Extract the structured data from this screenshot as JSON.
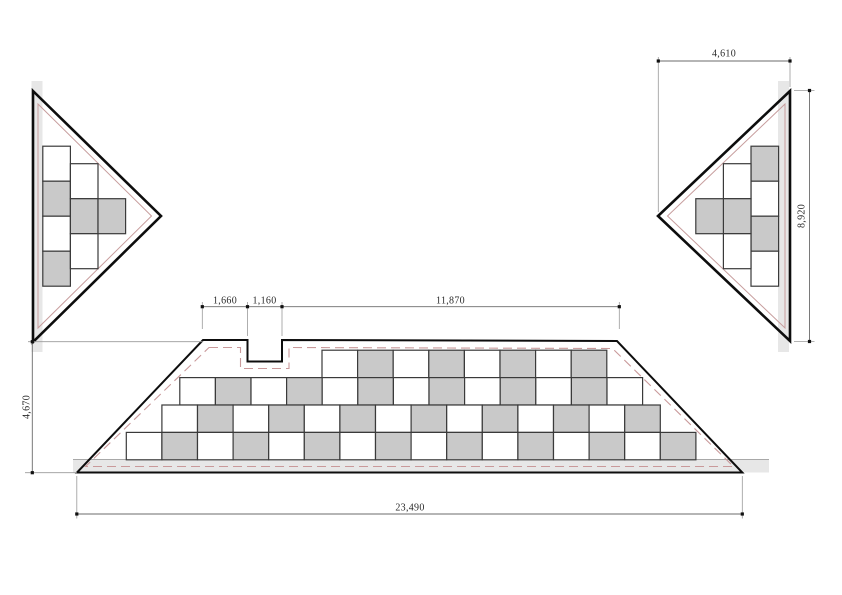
{
  "drawing": {
    "canvas": {
      "width": 842,
      "height": 595,
      "background": "#ffffff"
    },
    "palette": {
      "cell_gray": "#c9c9c9",
      "cell_white": "#ffffff",
      "cell_stroke": "#3a3a3a",
      "cell_stroke_w": 1.2,
      "outline_black": "#0d0d0d",
      "band_gray": "#e7e7e7",
      "pink_solid": "#c79d9d",
      "pink_dashed": "#c9999a",
      "dim_line": "#6b6b6b",
      "ext_line": "#9a9a9a",
      "dot": "#111111"
    },
    "dims": [
      {
        "label": "4,610",
        "x": 724,
        "y": 54,
        "rot": 0
      },
      {
        "label": "8,920",
        "x": 801.5,
        "y": 216,
        "rot": -90
      },
      {
        "label": "4,670",
        "x": 26.5,
        "y": 407,
        "rot": -90
      },
      {
        "label": "1,660",
        "x": 225,
        "y": 300.5,
        "rot": 0
      },
      {
        "label": "1,160",
        "x": 264.5,
        "y": 300.5,
        "rot": 0
      },
      {
        "label": "11,870",
        "x": 450.5,
        "y": 300.5,
        "rot": 0
      },
      {
        "label": "23,490",
        "x": 410,
        "y": 508,
        "rot": 0
      }
    ],
    "shapes": [
      {
        "t": "rect",
        "x": 31.5,
        "y": 81,
        "w": 11,
        "h": 271,
        "f": "#e7e7e7"
      },
      {
        "t": "rect",
        "x": 778,
        "y": 81,
        "w": 11,
        "h": 271,
        "f": "#e7e7e7"
      },
      {
        "t": "rect",
        "x": 73,
        "y": 459.5,
        "w": 696,
        "h": 13,
        "f": "#e7e7e7"
      },
      {
        "t": "line",
        "p": [
          [
            73,
            459.5
          ],
          [
            769,
            459.5
          ]
        ],
        "s": "#a8a8a8",
        "sw": 0.9
      },
      {
        "t": "poly",
        "p": [
          [
            38,
            104
          ],
          [
            151.5,
            216
          ],
          [
            38,
            328
          ]
        ],
        "s": "#c79d9d",
        "sw": 1
      },
      {
        "t": "poly",
        "p": [
          [
            785,
            104
          ],
          [
            667.5,
            216
          ],
          [
            785,
            328
          ]
        ],
        "s": "#c79d9d",
        "sw": 1
      },
      {
        "t": "poly",
        "p": [
          [
            209,
            347.5
          ],
          [
            240.5,
            347.5
          ],
          [
            240.5,
            368.5
          ],
          [
            289,
            368.5
          ],
          [
            289,
            347.5
          ],
          [
            612.5,
            348.5
          ],
          [
            733.5,
            466.5
          ],
          [
            85.5,
            466.5
          ]
        ],
        "s": "#c9999a",
        "sw": 1.1,
        "d": "9 5"
      },
      {
        "t": "cells",
        "dir": "v",
        "x": 42.8,
        "y": 146.2,
        "w": 27.6,
        "h": 35,
        "c": "WGWG"
      },
      {
        "t": "cells",
        "dir": "v",
        "x": 70.4,
        "y": 163.7,
        "w": 27.6,
        "h": 35,
        "c": "WGW"
      },
      {
        "t": "cells",
        "dir": "v",
        "x": 98.0,
        "y": 198.7,
        "w": 27.6,
        "h": 35,
        "c": "G"
      },
      {
        "t": "cells",
        "dir": "v",
        "x": 751.0,
        "y": 146.2,
        "w": 27.6,
        "h": 35,
        "c": "GWGW"
      },
      {
        "t": "cells",
        "dir": "v",
        "x": 723.4,
        "y": 163.7,
        "w": 27.6,
        "h": 35,
        "c": "WGW"
      },
      {
        "t": "cells",
        "dir": "v",
        "x": 695.8,
        "y": 198.7,
        "w": 27.6,
        "h": 35,
        "c": "G"
      },
      {
        "t": "cells",
        "dir": "h",
        "x": 322.0,
        "y": 350.2,
        "w": 35.6,
        "h": 27.4,
        "c": "WGWGWGWG"
      },
      {
        "t": "cells",
        "dir": "h",
        "x": 179.8,
        "y": 377.6,
        "w": 35.6,
        "h": 27.4,
        "c": "WGWGWGWGWGWGW"
      },
      {
        "t": "cells",
        "dir": "h",
        "x": 161.9,
        "y": 405.0,
        "w": 35.6,
        "h": 27.4,
        "c": "WGWGWGWGWGWGWG"
      },
      {
        "t": "cells",
        "dir": "h",
        "x": 126.3,
        "y": 432.4,
        "w": 35.6,
        "h": 27.4,
        "c": "WGWGWGWGWGWGWGWG"
      },
      {
        "t": "poly",
        "p": [
          [
            33,
            91
          ],
          [
            161,
            216
          ],
          [
            33,
            342
          ]
        ],
        "s": "#0d0d0d",
        "sw": 2.6
      },
      {
        "t": "poly",
        "p": [
          [
            790,
            91
          ],
          [
            658,
            216
          ],
          [
            790,
            341
          ]
        ],
        "s": "#0d0d0d",
        "sw": 2.6
      },
      {
        "t": "poly",
        "p": [
          [
            203,
            340
          ],
          [
            247.5,
            340
          ],
          [
            247.5,
            361.5
          ],
          [
            282,
            361.5
          ],
          [
            282,
            340
          ],
          [
            617,
            341
          ],
          [
            742.3,
            472.5
          ],
          [
            77,
            472.5
          ]
        ],
        "s": "#0d0d0d",
        "sw": 2
      },
      {
        "t": "line",
        "p": [
          [
            28,
            341.7
          ],
          [
            203,
            341.7
          ]
        ],
        "s": "#9a9a9a",
        "sw": 0.8
      },
      {
        "t": "line",
        "p": [
          [
            25,
            472.7
          ],
          [
            77,
            472.7
          ]
        ],
        "s": "#9a9a9a",
        "sw": 0.8
      },
      {
        "t": "line",
        "p": [
          [
            202.3,
            302
          ],
          [
            202.3,
            329
          ]
        ],
        "s": "#9a9a9a",
        "sw": 0.8
      },
      {
        "t": "line",
        "p": [
          [
            247.5,
            302
          ],
          [
            247.5,
            336
          ]
        ],
        "s": "#9a9a9a",
        "sw": 0.8
      },
      {
        "t": "line",
        "p": [
          [
            282,
            302
          ],
          [
            282,
            336
          ]
        ],
        "s": "#9a9a9a",
        "sw": 0.8
      },
      {
        "t": "line",
        "p": [
          [
            619.3,
            302
          ],
          [
            619.3,
            329
          ]
        ],
        "s": "#9a9a9a",
        "sw": 0.8
      },
      {
        "t": "line",
        "p": [
          [
            76.8,
            476
          ],
          [
            76.8,
            518.5
          ]
        ],
        "s": "#9a9a9a",
        "sw": 0.8
      },
      {
        "t": "line",
        "p": [
          [
            742.3,
            476
          ],
          [
            742.3,
            518.5
          ]
        ],
        "s": "#9a9a9a",
        "sw": 0.8
      },
      {
        "t": "line",
        "p": [
          [
            658.3,
            57
          ],
          [
            658.3,
            212
          ]
        ],
        "s": "#9a9a9a",
        "sw": 0.8
      },
      {
        "t": "line",
        "p": [
          [
            790,
            57
          ],
          [
            790,
            87
          ]
        ],
        "s": "#9a9a9a",
        "sw": 0.8
      },
      {
        "t": "line",
        "p": [
          [
            794,
            90.5
          ],
          [
            814.5,
            90.5
          ]
        ],
        "s": "#9a9a9a",
        "sw": 0.8
      },
      {
        "t": "line",
        "p": [
          [
            794,
            341.5
          ],
          [
            814.5,
            341.5
          ]
        ],
        "s": "#9a9a9a",
        "sw": 0.8
      },
      {
        "t": "line",
        "p": [
          [
            32.3,
            341.7
          ],
          [
            32.3,
            472.7
          ]
        ],
        "s": "#6b6b6b",
        "sw": 0.9
      },
      {
        "t": "line",
        "p": [
          [
            202.3,
            306.7
          ],
          [
            619.3,
            306.7
          ]
        ],
        "s": "#6b6b6b",
        "sw": 0.9
      },
      {
        "t": "line",
        "p": [
          [
            76.8,
            514
          ],
          [
            742.3,
            514
          ]
        ],
        "s": "#6b6b6b",
        "sw": 0.9
      },
      {
        "t": "line",
        "p": [
          [
            658.3,
            61
          ],
          [
            790,
            61
          ]
        ],
        "s": "#6b6b6b",
        "sw": 0.9
      },
      {
        "t": "line",
        "p": [
          [
            809.5,
            90.5
          ],
          [
            809.5,
            341.5
          ]
        ],
        "s": "#6b6b6b",
        "sw": 0.9
      },
      {
        "t": "dot",
        "x": 32.3,
        "y": 341.7
      },
      {
        "t": "dot",
        "x": 32.3,
        "y": 472.7
      },
      {
        "t": "dot",
        "x": 202.3,
        "y": 306.7
      },
      {
        "t": "dot",
        "x": 247.5,
        "y": 306.7
      },
      {
        "t": "dot",
        "x": 282,
        "y": 306.7
      },
      {
        "t": "dot",
        "x": 619.3,
        "y": 306.7
      },
      {
        "t": "dot",
        "x": 76.8,
        "y": 514
      },
      {
        "t": "dot",
        "x": 742.3,
        "y": 514
      },
      {
        "t": "dot",
        "x": 658.3,
        "y": 61
      },
      {
        "t": "dot",
        "x": 790,
        "y": 61
      },
      {
        "t": "dot",
        "x": 809.5,
        "y": 90.5
      },
      {
        "t": "dot",
        "x": 809.5,
        "y": 341.5
      }
    ]
  }
}
